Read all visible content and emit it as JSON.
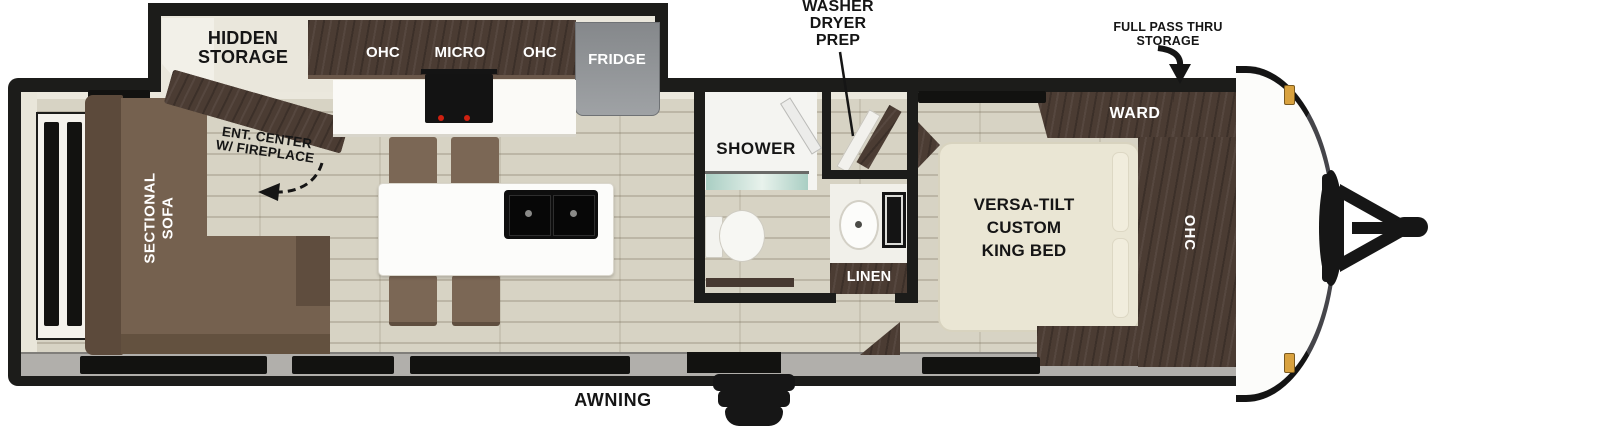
{
  "trailer": {
    "colors": {
      "wall": "#1c1c1a",
      "floor": "#d7d3c4",
      "cabinet": "#4b3c33",
      "sofa": "#75614f",
      "bed": "#eae6d4",
      "fridge": "#8b8e90",
      "marker_light": "#d9a23f",
      "shower_glass": "#a9cec3"
    },
    "exterior": {
      "washer_dryer_prep_label": "WASHER\nDRYER\nPREP",
      "full_pass_thru_label": "FULL PASS THRU\nSTORAGE",
      "awning_label": "AWNING"
    },
    "living_area": {
      "hidden_storage_label": "HIDDEN\nSTORAGE",
      "ent_center_label": "ENT. CENTER\nW/ FIREPLACE",
      "sofa_label": "SECTIONAL\nSOFA"
    },
    "kitchen": {
      "ohc_left_label": "OHC",
      "micro_label": "MICRO",
      "ohc_right_label": "OHC",
      "fridge_label": "FRIDGE"
    },
    "bathroom": {
      "shower_label": "SHOWER",
      "linen_label": "LINEN"
    },
    "bedroom": {
      "bed_label": "VERSA-TILT\nCUSTOM\nKING BED",
      "ward_label": "WARD",
      "ohc_label": "OHC"
    }
  }
}
